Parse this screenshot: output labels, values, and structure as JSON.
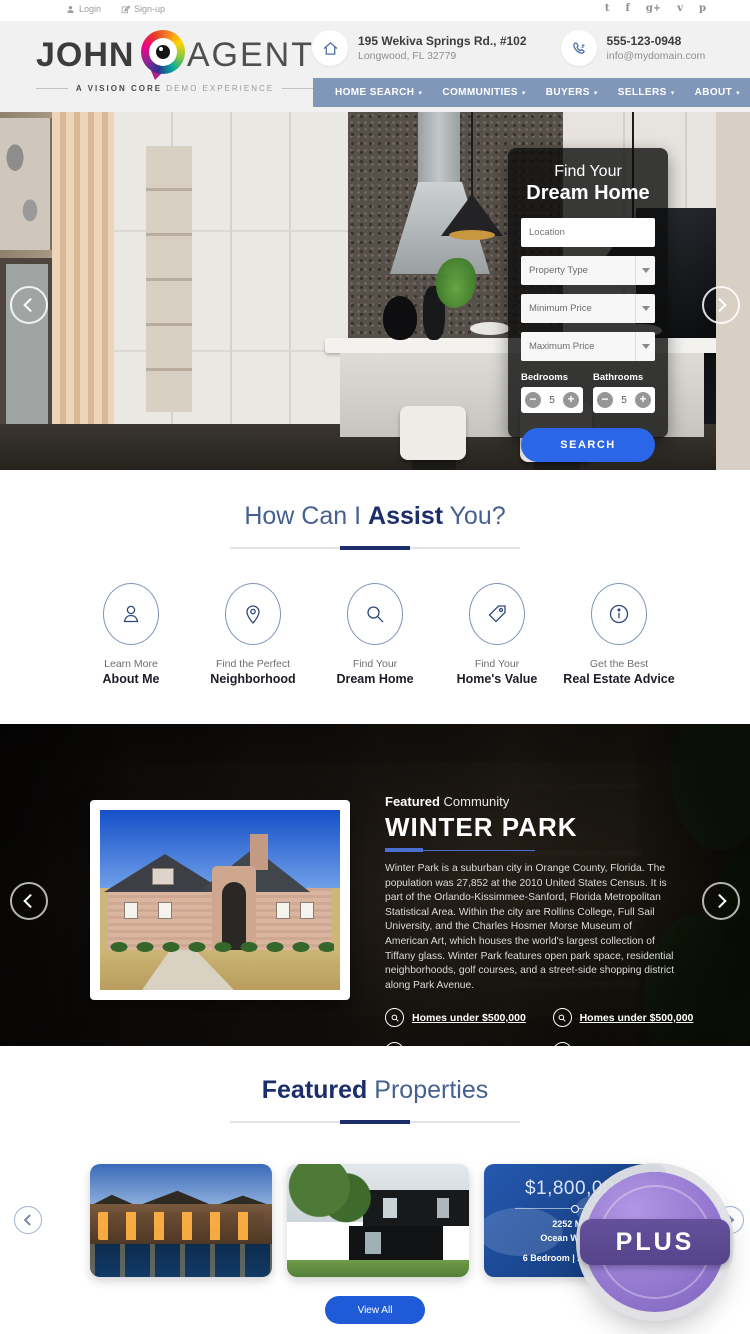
{
  "topbar": {
    "login_label": "Login",
    "signup_label": "Sign-up",
    "social": {
      "twitter": "t",
      "facebook": "f",
      "google_plus": "g+",
      "vimeo": "v",
      "pinterest": "p"
    }
  },
  "header": {
    "logo_first": "JOHN",
    "logo_last": "AGENT",
    "tagline_bold": "A VISION CORE",
    "tagline_rest": " DEMO EXPERIENCE",
    "address_line1": "195 Wekiva Springs Rd., #102",
    "address_line2": "Longwood, FL 32779",
    "phone_number": "555-123-0948",
    "email": "info@mydomain.com"
  },
  "nav": {
    "items": [
      {
        "label": "HOME SEARCH",
        "caret": "▾"
      },
      {
        "label": "COMMUNITIES",
        "caret": "▾"
      },
      {
        "label": "BUYERS",
        "caret": "▾"
      },
      {
        "label": "SELLERS",
        "caret": "▾"
      },
      {
        "label": "ABOUT",
        "caret": "▾"
      },
      {
        "label": "CONTACT",
        "caret": ""
      }
    ]
  },
  "hero": {
    "form": {
      "title_line1": "Find Your",
      "title_line2": "Dream Home",
      "location_placeholder": "Location",
      "property_type": "Property Type",
      "min_price": "Minimum Price",
      "max_price": "Maximum Price",
      "bedrooms_label": "Bedrooms",
      "bathrooms_label": "Bathrooms",
      "bedrooms_value": "5",
      "bathrooms_value": "5",
      "search_label": "SEARCH"
    }
  },
  "assist": {
    "title_pre": "How Can I ",
    "title_bold": "Assist",
    "title_post": " You?",
    "items": [
      {
        "icon": "user-icon",
        "line1": "Learn More",
        "line2": "About Me"
      },
      {
        "icon": "map-pin-icon",
        "line1": "Find the Perfect",
        "line2": "Neighborhood"
      },
      {
        "icon": "search-icon",
        "line1": "Find Your",
        "line2": "Dream Home"
      },
      {
        "icon": "tag-icon",
        "line1": "Find Your",
        "line2": "Home's Value"
      },
      {
        "icon": "info-icon",
        "line1": "Get the Best",
        "line2": "Real Estate Advice"
      }
    ]
  },
  "community": {
    "eyebrow_bold": "Featured",
    "eyebrow_rest": " Community",
    "title": "WINTER PARK",
    "description": "Winter Park is a suburban city in Orange County, Florida. The population was 27,852 at the 2010 United States Census. It is part of the Orlando-Kissimmee-Sanford, Florida Metropolitan Statistical Area. Within the city are Rollins College, Full Sail University, and the Charles Hosmer Morse Museum of American Art, which houses the world's largest collection of Tiffany glass. Winter Park features open park space, residential neighborhoods, golf courses, and a street-side shopping district along Park Avenue.",
    "links": [
      "Homes under $500,000",
      "Homes under $500,000",
      "Homes under $1,000,000",
      "Homes under $1,000,000"
    ]
  },
  "properties": {
    "title_bold": "Featured",
    "title_rest": " Properties",
    "featured_card": {
      "price": "$1,800,000",
      "address_line1": "2252 Maga",
      "address_line2": "Ocean Walk , FL",
      "details": "6 Bedroom | 2 Bathroom"
    },
    "view_all_label": "View All"
  },
  "plus_badge": {
    "label": "PLUS"
  },
  "colors": {
    "nav_blue": "#8097ba",
    "navy": "#1b2d6b",
    "heading_light": "#46618f",
    "button_blue": "#2b66e9",
    "badge_purple": "#8f74cc",
    "badge_band_purple": "#5b4a8c"
  }
}
